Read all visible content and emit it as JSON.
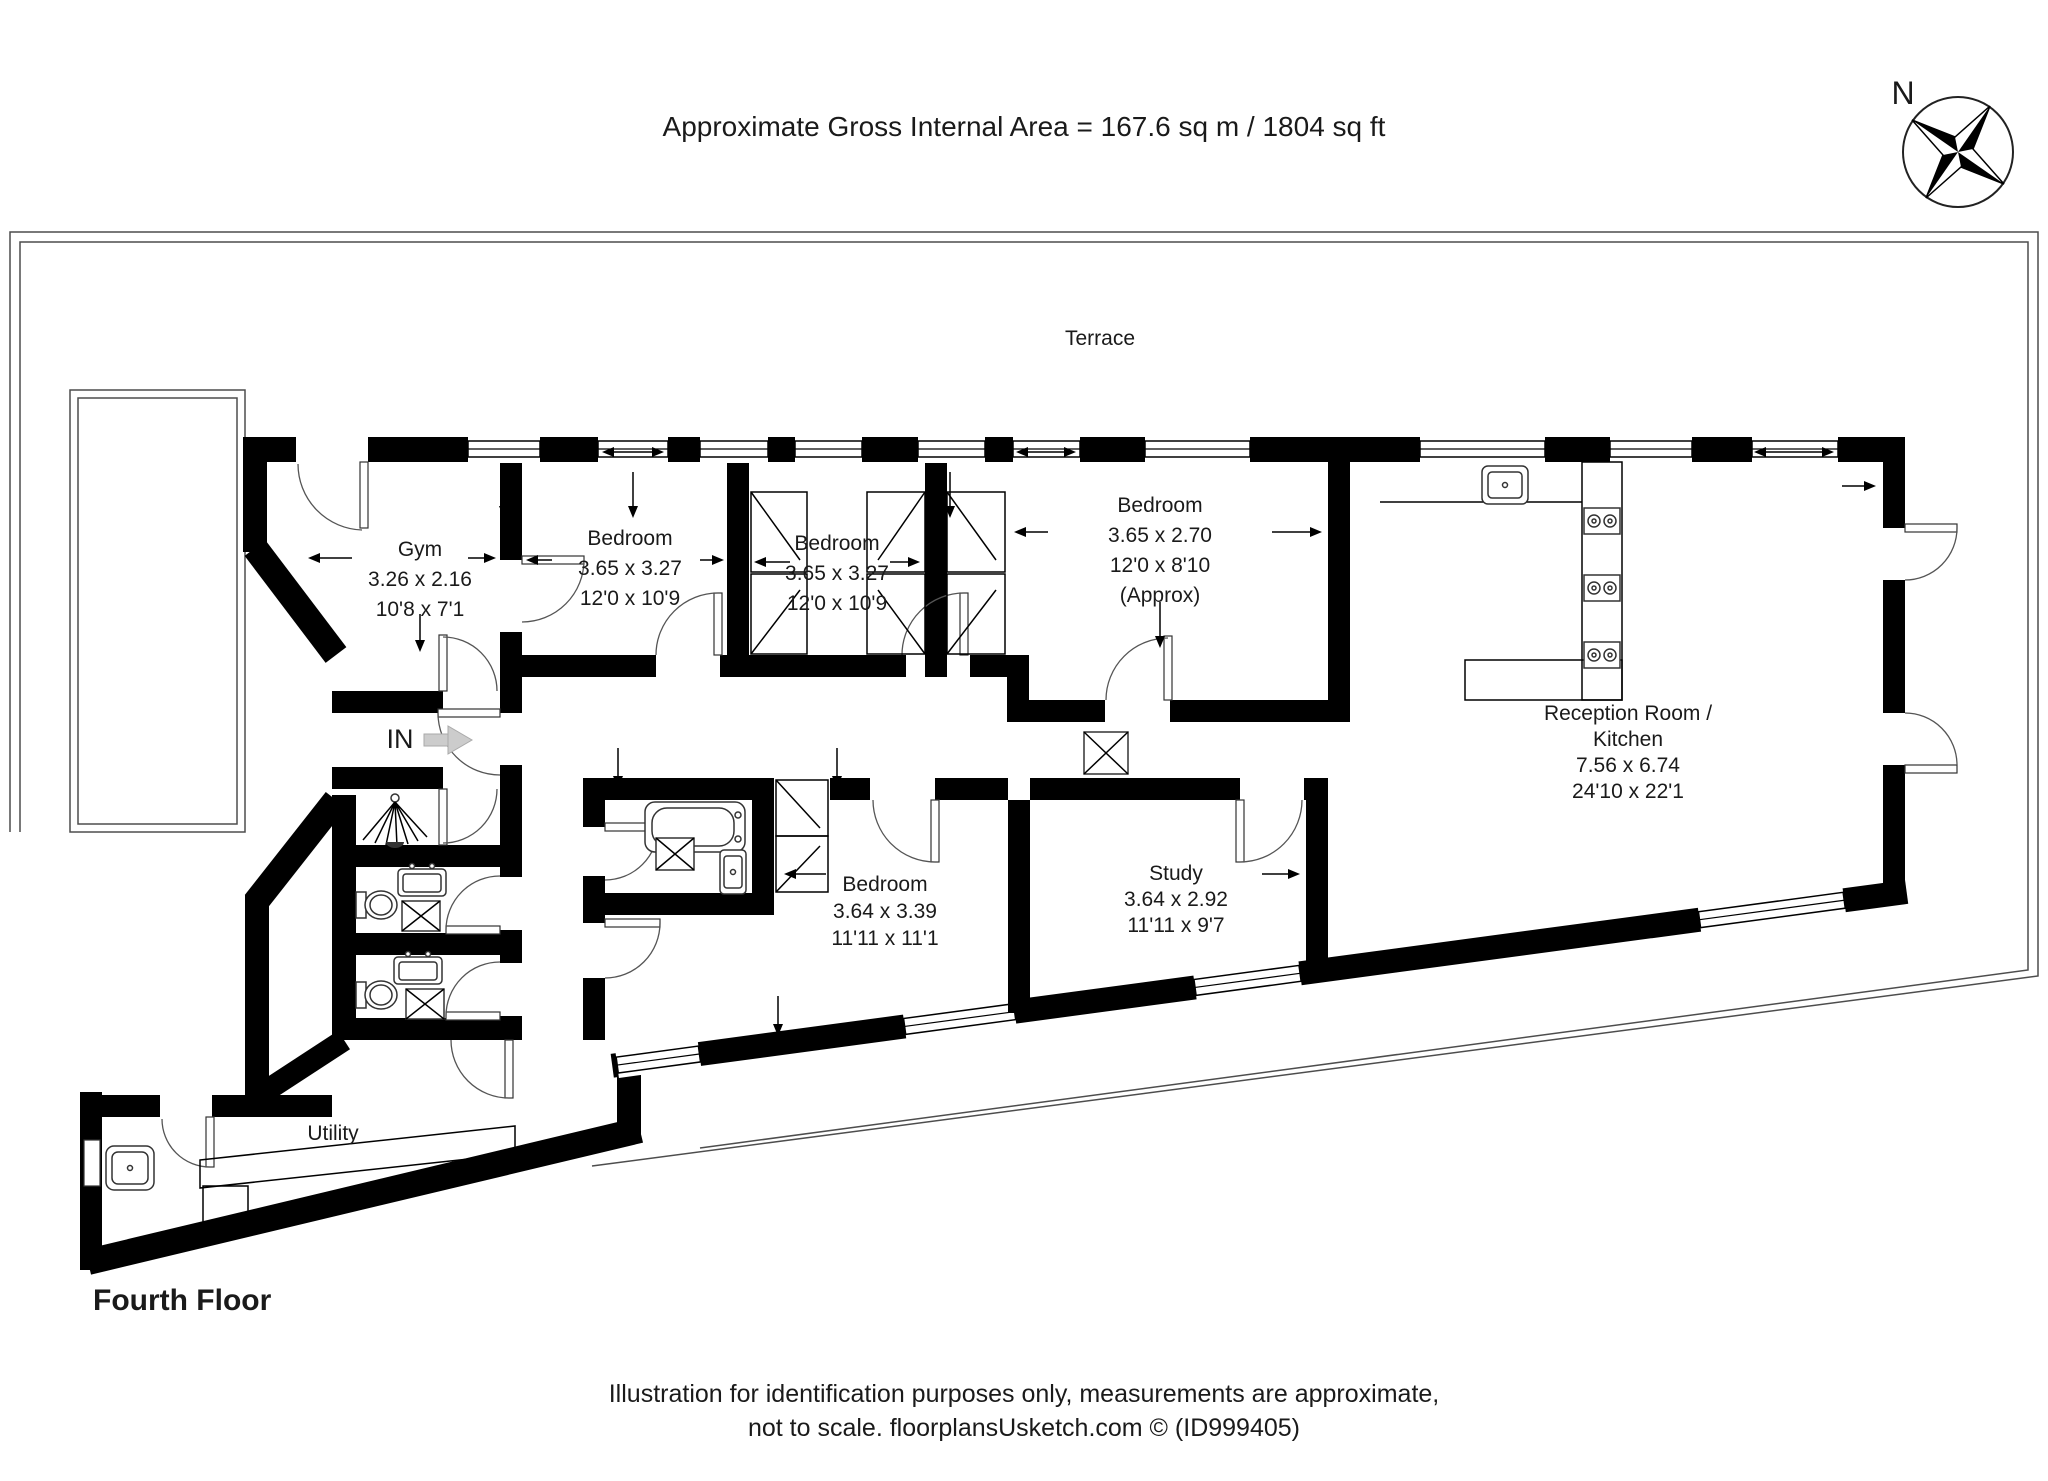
{
  "header": {
    "title": "Approximate Gross Internal Area = 167.6 sq m / 1804 sq ft"
  },
  "compass": {
    "label": "N"
  },
  "terrace": {
    "label": "Terrace"
  },
  "entrance": {
    "label": "IN"
  },
  "floor": {
    "name": "Fourth Floor"
  },
  "rooms": [
    {
      "id": "gym",
      "name": "Gym",
      "metric": "3.26 x 2.16",
      "imperial": "10'8 x 7'1"
    },
    {
      "id": "bedroom-1",
      "name": "Bedroom",
      "metric": "3.65 x 3.27",
      "imperial": "12'0 x 10'9"
    },
    {
      "id": "bedroom-2",
      "name": "Bedroom",
      "metric": "3.65 x 3.27",
      "imperial": "12'0 x 10'9"
    },
    {
      "id": "bedroom-3",
      "name": "Bedroom",
      "metric": "3.65 x 2.70",
      "imperial": "12'0 x 8'10",
      "note": "(Approx)"
    },
    {
      "id": "reception-kitchen",
      "name": "Reception Room / Kitchen",
      "line1": "Reception Room /",
      "line2": "Kitchen",
      "metric": "7.56 x 6.74",
      "imperial": "24'10 x 22'1"
    },
    {
      "id": "bedroom-4",
      "name": "Bedroom",
      "metric": "3.64 x 3.39",
      "imperial": "11'11 x 11'1"
    },
    {
      "id": "study",
      "name": "Study",
      "metric": "3.64 x 2.92",
      "imperial": "11'11 x 9'7"
    },
    {
      "id": "utility",
      "name": "Utility"
    }
  ],
  "footer": {
    "line1": "Illustration for identification purposes only, measurements are approximate,",
    "line2": "not to scale. floorplansUsketch.com © (ID999405)"
  },
  "colors": {
    "wall": "#000000",
    "paper": "#ffffff",
    "entry_arrow": "#c9c9c9"
  }
}
